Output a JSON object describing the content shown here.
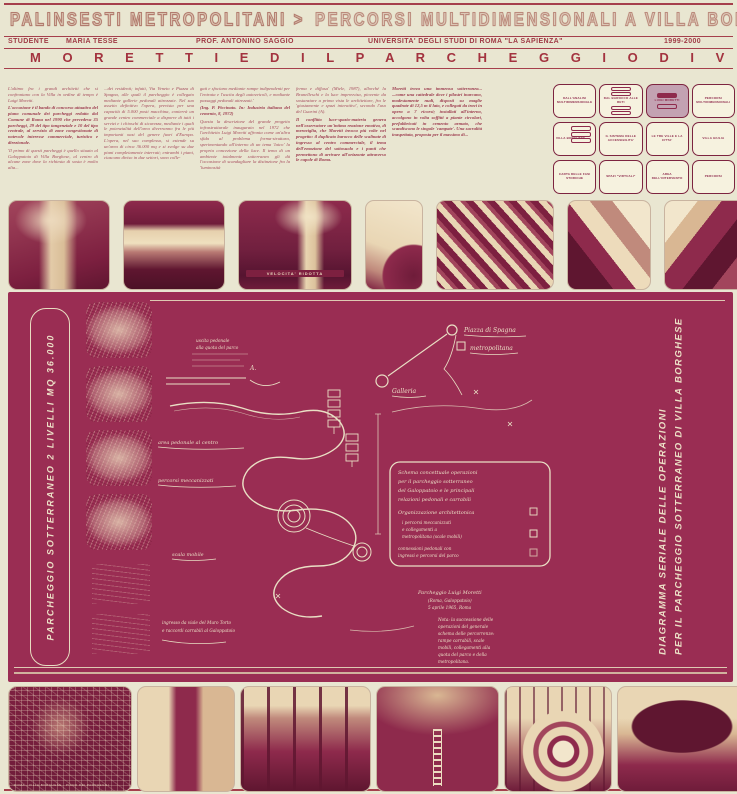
{
  "header": {
    "title_left": "PALINSESTI METROPOLITANI >",
    "title_right": "PERCORSI MULTIDIMENSIONALI A VILLA BORGHESE",
    "studente_label": "STUDENTE",
    "studente_name": "MARIA TESSE",
    "prof": "PROF. ANTONINO SAGGIO",
    "universita": "UNIVERSITA' DEGLI STUDI DI ROMA \"LA SAPIENZA\"",
    "anno": "1999-2000",
    "subtitle": "M O R E T T I   E D   I L   P A R C H E G G I O   D I   V I L L A   B O R G H E S E"
  },
  "columns": {
    "c1": {
      "p0": "L'ultimo fra i grandi architetti che si confrontano con la Villa in ordine di tempo è Luigi Moretti.",
      "p1": "L'occasione è il bando di concorso attuativo del piano comunale dei parcheggi redatto dal Comune di Roma nel 1990 che prevedeva 35 parcheggi, 29 del tipo tangenziale e 10 del tipo centrale, al servizio di zone congestionate di notevole interesse commerciale, turistico e direzionale.",
      "p2": "'Il primo di questi parcheggi è quello situato al Galoppatoio di Villa Borghese, al centro di alcune zone dove la richiesta di sosta è molto alta..."
    },
    "c2": {
      "p0": "...dei residenti; infatti, Via Veneto e Piazza di Spagna, alle quali il parcheggio è collegato mediante gallerie pedonali attrezzate. Nel suo assetto definitivo l'opera, prevista per una capacità di 5.000 posti macchina, conterrà un grande centro commerciale a disporre di tutti i servizi e i chioschi di sicurezza, mediante i quali le potenzialità dell'area diverranno fra le più importanti oasi del genere fuori d'Europa. L'opera, nel suo complesso, si estende su un'area di circa 36.000 mq e si svolge su due piani completamente interrati; entrambi i piani, ciascuno diviso in due settori, sono colle-"
    },
    "c3": {
      "p0": "gati e sfociano mediante rampe indipendenti per l'entrata e l'uscita degli autoveicoli, e mediante passaggi pedonali attrezzati.'",
      "p1": "(Ing. P. Piccinato. In: Industria italiana del cemento, 8, 1972)",
      "p2": "Questa la descrizione del grande progetto infrastrutturale inaugurato nel 1972 che l'architetto Luigi Moretti affronta come un'altra sfida al problema forma-struttura, sperimentando all'interno di un tema 'laico' la propria concezione della luce. Il tema di un ambiente totalmente sotterraneo gli dà l'occasione di scandagliare la distinzione fra la 'luminosità"
    },
    "c4": {
      "p0": "ferma e diffusa' (Miele, 1987), allorché la Brunelleschi e la luce improvvisa, piovente da sostanziare a prima vista le architetture, fra le 'giustamente e spazi interattivi', secondo l'uso del Guarini (A).",
      "p1": "Il conflitto luce-spazio-materia genera nell'osservatore un'intima reazione emotiva, di meraviglia, che Moretti invoca più volte nel progetto: il duplicato barocco delle scalinate di ingresso al centro commerciale, il tema dell'emozione del sottosuolo e i punti che permettono di arrivare all'orizzonte attraverso le cupole di Roma."
    },
    "c5": {
      "p0": "Moretti trova una immensa sotterranea... ...come una cattedrale dove i pilastri inarcano, modestamente nudi, disposti su maglie quadrate di 12,5 m il lato, e collegati da travi in opera a 7 ricorsi; installati all'interno, accolgono in volta soffitti a piante circolari, prefabbricati in cemento armato, che scandiscono le singole 'campate'. Una sacralità inaspettata, proposta per il massimo di..."
    }
  },
  "index_grid": {
    "cells": [
      {
        "label": "DALL'ANALISI MULTIDIMENSIONALE"
      },
      {
        "label": "DAL BAROCCO ALLE RETI"
      },
      {
        "label": "LUIGI MORETTI"
      },
      {
        "label": "PERCORSI MULTIDIMENSIONALI"
      },
      {
        "label": "VILLA BORGHESE"
      },
      {
        "label": "IL SISTEMA DELLE ACCESSIBILITA'"
      },
      {
        "label": "LE TRE VILLE E LA CITTA'"
      },
      {
        "label": "VILLA GIULIA"
      },
      {
        "label": "CARTA DELLE FASI STORICHE"
      },
      {
        "label": "SPAZI \"VIRTUALI\""
      },
      {
        "label": "AREA DELL'INTERVENTO"
      },
      {
        "label": "PERCORSI"
      }
    ]
  },
  "photos": {
    "sign_top3": "VELOCITA' RIDOTTA",
    "map_caption": "ROMA · VILLA BORGHESE · PIANO DEI PARCHEGGI"
  },
  "panel": {
    "left_vertical": "PARCHEGGIO SOTTERRANEO          2 LIVELLI   MQ 36.000",
    "right_vertical_line1": "DIAGRAMMA SERIALE DELLE OPERAZIONI",
    "right_vertical_line2": "PER IL PARCHEGGIO SOTTERRANEO DI VILLA BORGHESE",
    "diagram": {
      "label_piazza": "Piazza di Spagna",
      "label_metro": "metropolitana",
      "label_galleria": "Galleria",
      "label_a": "A.",
      "d1": "uscita pedonale",
      "d2": "alla quota del parco",
      "d3": "area pedonale al centro",
      "d4": "percorsi meccanizzati",
      "d5": "scala mobile",
      "d6": "rampa carrabile",
      "legend": {
        "l1": "Schema concettuale operazioni",
        "l2": "per il parcheggio sotterraneo",
        "l3": "del Galoppatoio e le principali",
        "l4": "relazioni pedonali e carrabili",
        "l5": "Organizzazione architettonica",
        "l6": "i percorsi meccanizzati",
        "l7": "e collegamenti a",
        "l8": "metropolitana (scale mobili)",
        "l9": "connessioni pedonali con",
        "l10": "ingressi e percorsi del parco"
      },
      "note": {
        "n1": "Parcheggio Luigi Moretti",
        "n2": "(Roma, Galoppatoio)",
        "n3": "5 aprile 1965, Roma",
        "n4": "Nota: la successione delle",
        "n5": "operazioni del generale",
        "n6": "schema delle percorrenze:",
        "n7": "rampe carrabili, scale",
        "n8": "mobili, collegamenti alla",
        "n9": "quota del parco e della",
        "n10": "metropolitana."
      },
      "b1": "ingresso da viale del Muro Torto",
      "b2": "e raccordi carrabili al Galoppatoio"
    }
  }
}
